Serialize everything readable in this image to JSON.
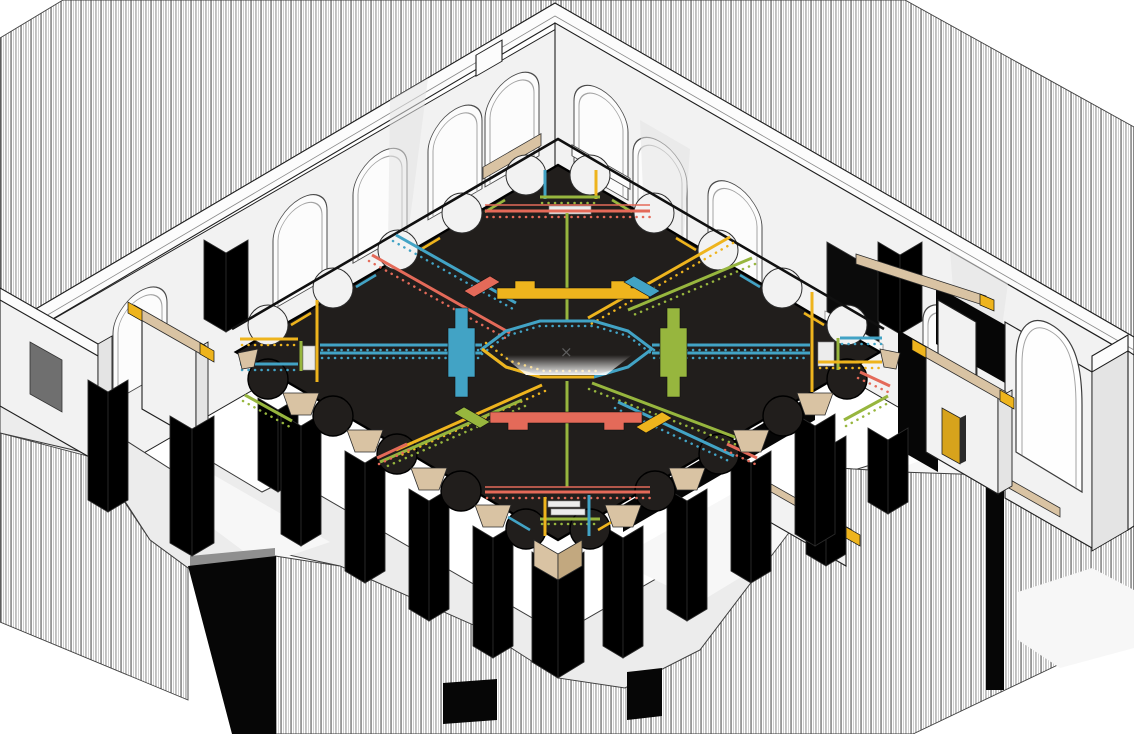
{
  "scene": {
    "kind": "axonometric-cutaway-illustration",
    "subject": "historic-hall-with-dark-painted-timber-ceiling",
    "center_mark": "×"
  },
  "palette": {
    "background": "#ffffff",
    "wall": "#f2f2f2",
    "wallTop": "#fcfcfc",
    "wallShade": "#e4e4e4",
    "line": "#1f1f1f",
    "ceiling": "#211e1c",
    "beamBlue": "#42a3c5",
    "beamYellow": "#eeb41d",
    "beamRed": "#e46a59",
    "beamGreen": "#97b63e",
    "wood": "#d9c3a3",
    "woodDark": "#c2a87f",
    "gold": "#d7a31c",
    "floor": "#ececec",
    "floorLight": "#f7f7f7",
    "windowFill": "#fcfcfc",
    "doorGray": "#6f6f6f",
    "holeGray": "#8f8f8f",
    "voidBlack": "#060606"
  },
  "inventory": [
    {
      "name": "section-cut-hatching-upper",
      "style": "vertical-line-hatch"
    },
    {
      "name": "section-cut-hatching-lower",
      "style": "vertical-line-hatch"
    },
    {
      "name": "left-wall-with-arched-windows",
      "windows": 6
    },
    {
      "name": "right-wall-with-arched-windows",
      "windows": 4
    },
    {
      "name": "right-wall-arched-doorway",
      "count": 1
    },
    {
      "name": "scalloped-black-ceiling",
      "scallop-arches-per-side": 5
    },
    {
      "name": "central-octagon-coffer",
      "border-colors": [
        "blue",
        "yellow"
      ]
    },
    {
      "name": "decorated-dentil-beams",
      "colors": [
        "blue",
        "yellow",
        "red",
        "green"
      ]
    },
    {
      "name": "flat-painted-bands",
      "colors": [
        "yellow",
        "red",
        "blue",
        "green"
      ]
    },
    {
      "name": "colonnade-pillars",
      "count": 9
    },
    {
      "name": "timber-corbels",
      "material-color": "tan"
    },
    {
      "name": "timber-tie-beams-with-gold-caps",
      "count": 4
    },
    {
      "name": "gold-door",
      "count": 1
    }
  ]
}
